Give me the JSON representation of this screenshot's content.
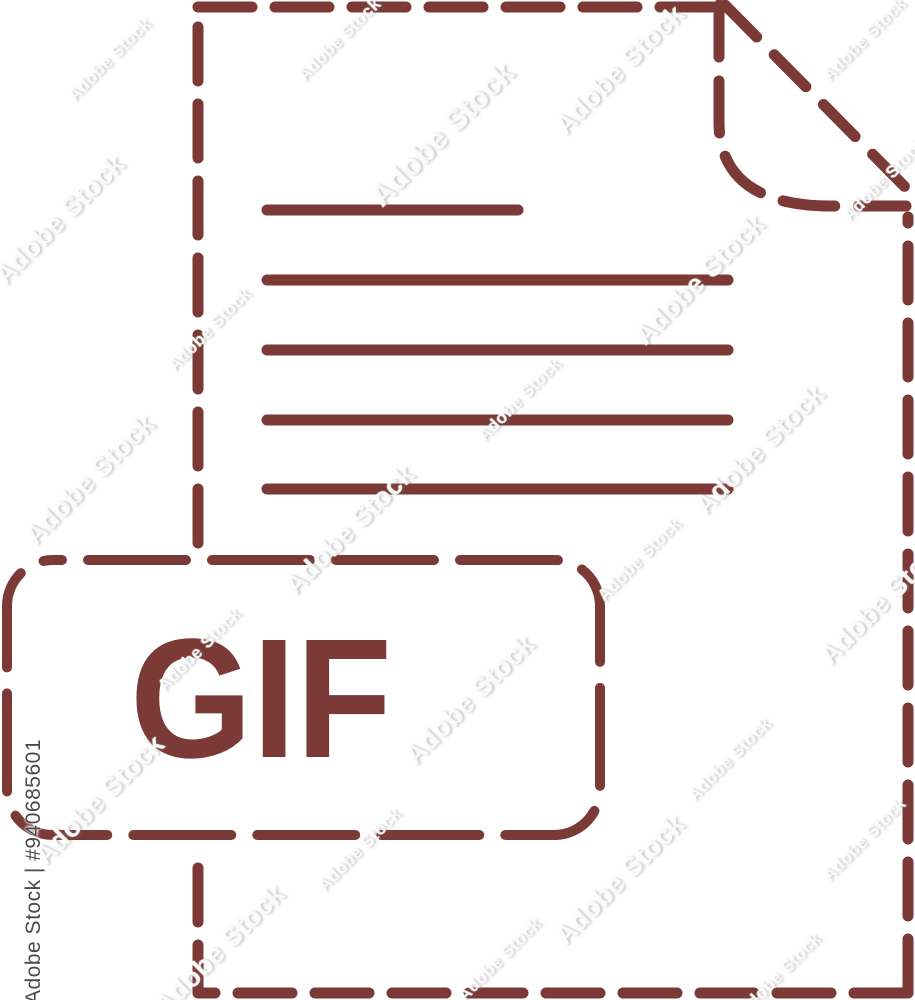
{
  "image": {
    "kind": "file-format-icon-stock-image",
    "background_color": "#ffffff"
  },
  "icon": {
    "file_type": "GIF",
    "accent_color": "#7b3a35",
    "shapes": {
      "document": "dashed-outline-page",
      "corner": "folded-top-right",
      "label": "dashed-rounded-rectangle"
    }
  },
  "watermark": {
    "tile_text": "Adobe Stock",
    "credit_text": "Adobe Stock | #940685601",
    "credit_color": "#4a4a4a"
  }
}
